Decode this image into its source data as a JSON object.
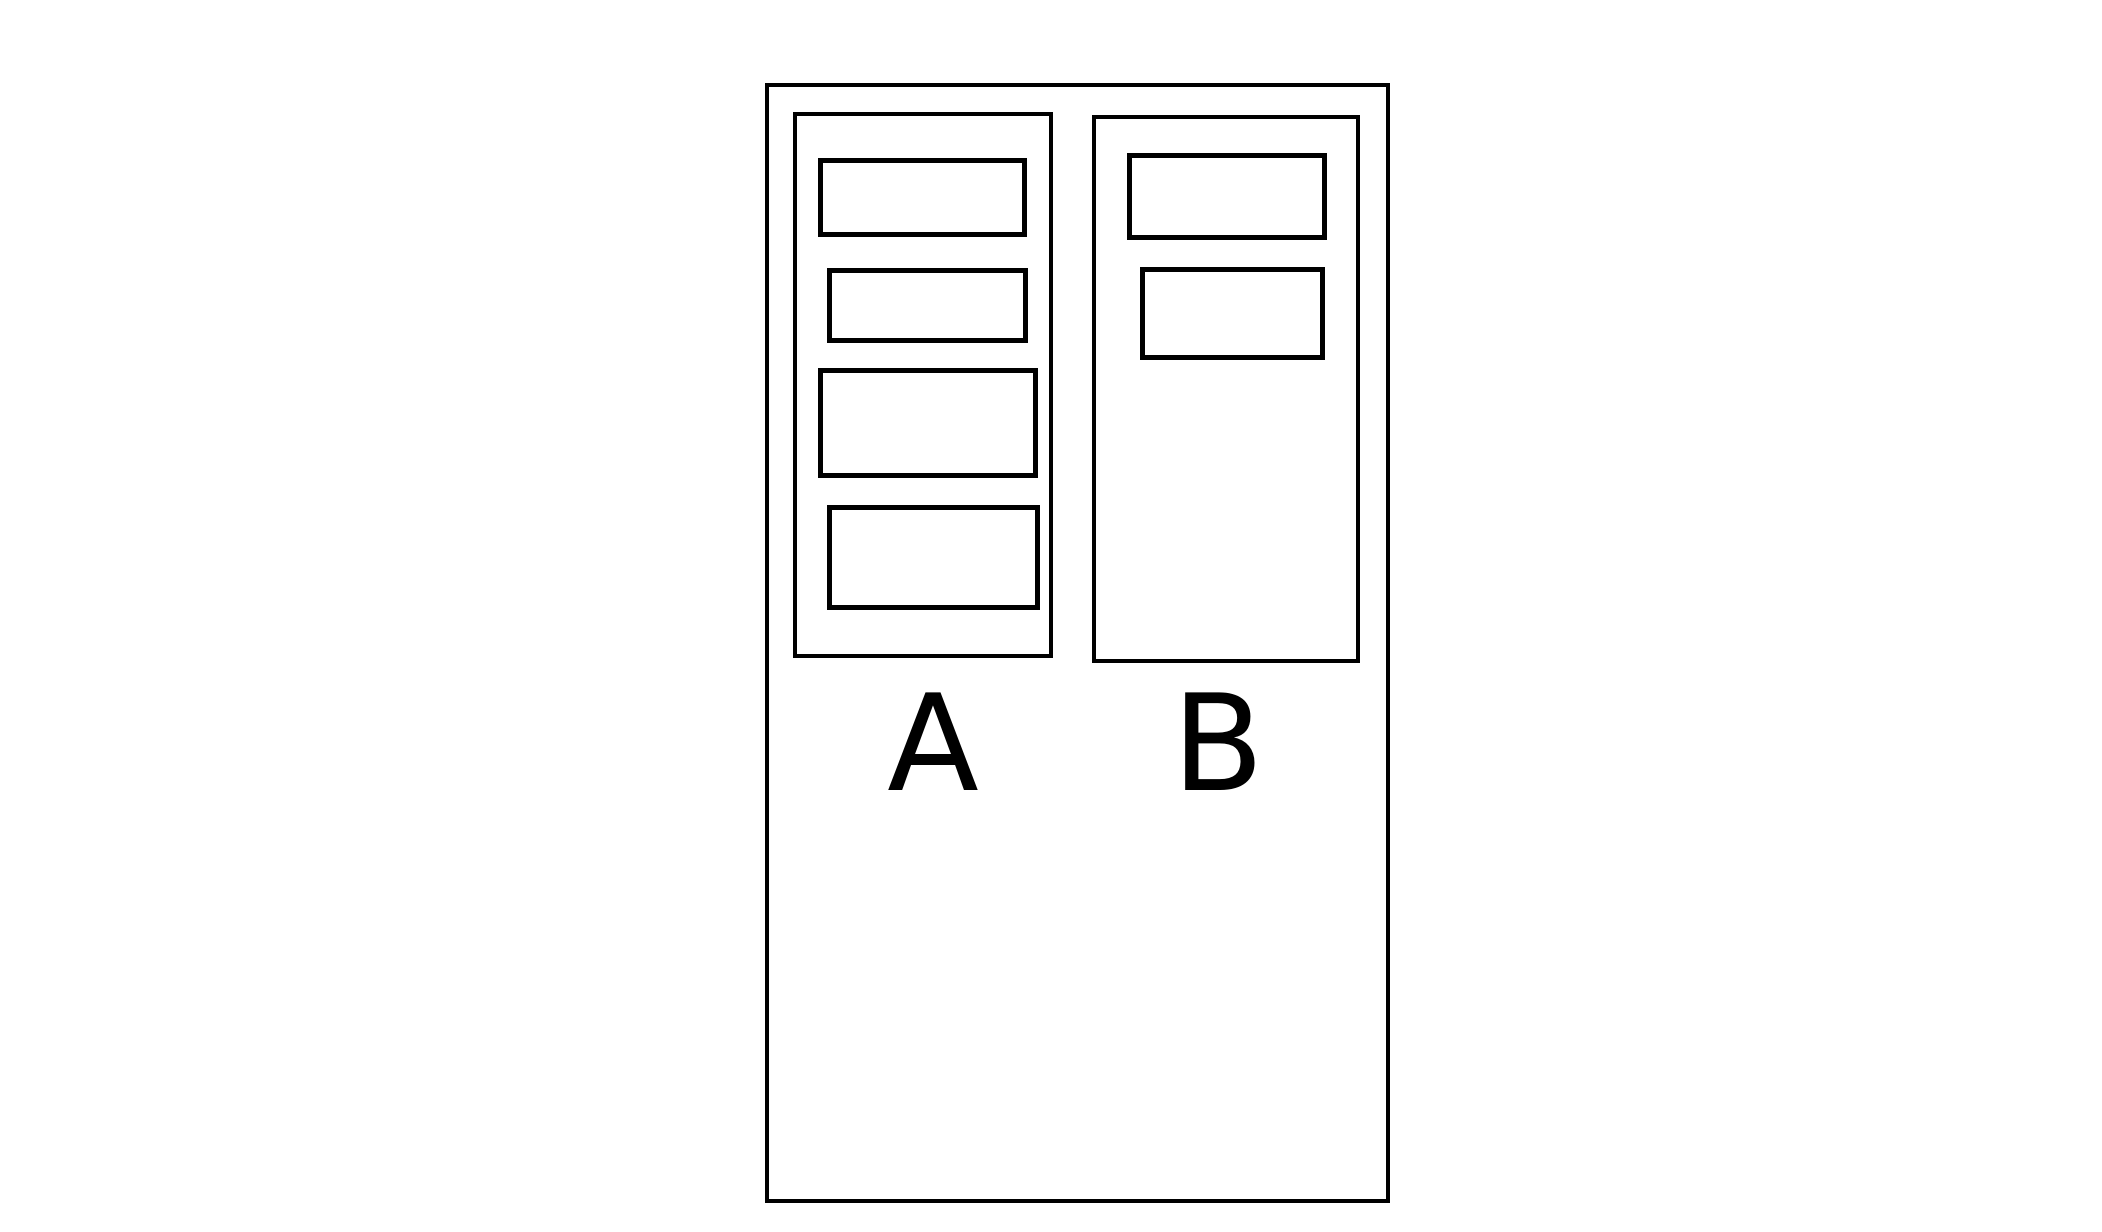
{
  "diagram": {
    "background_color": "#ffffff",
    "line_color": "#000000",
    "outer_container": {
      "description": "empty outer rectangle enclosing both groups"
    },
    "groups": [
      {
        "label": "A",
        "slot_count": 4
      },
      {
        "label": "B",
        "slot_count": 2
      }
    ]
  }
}
